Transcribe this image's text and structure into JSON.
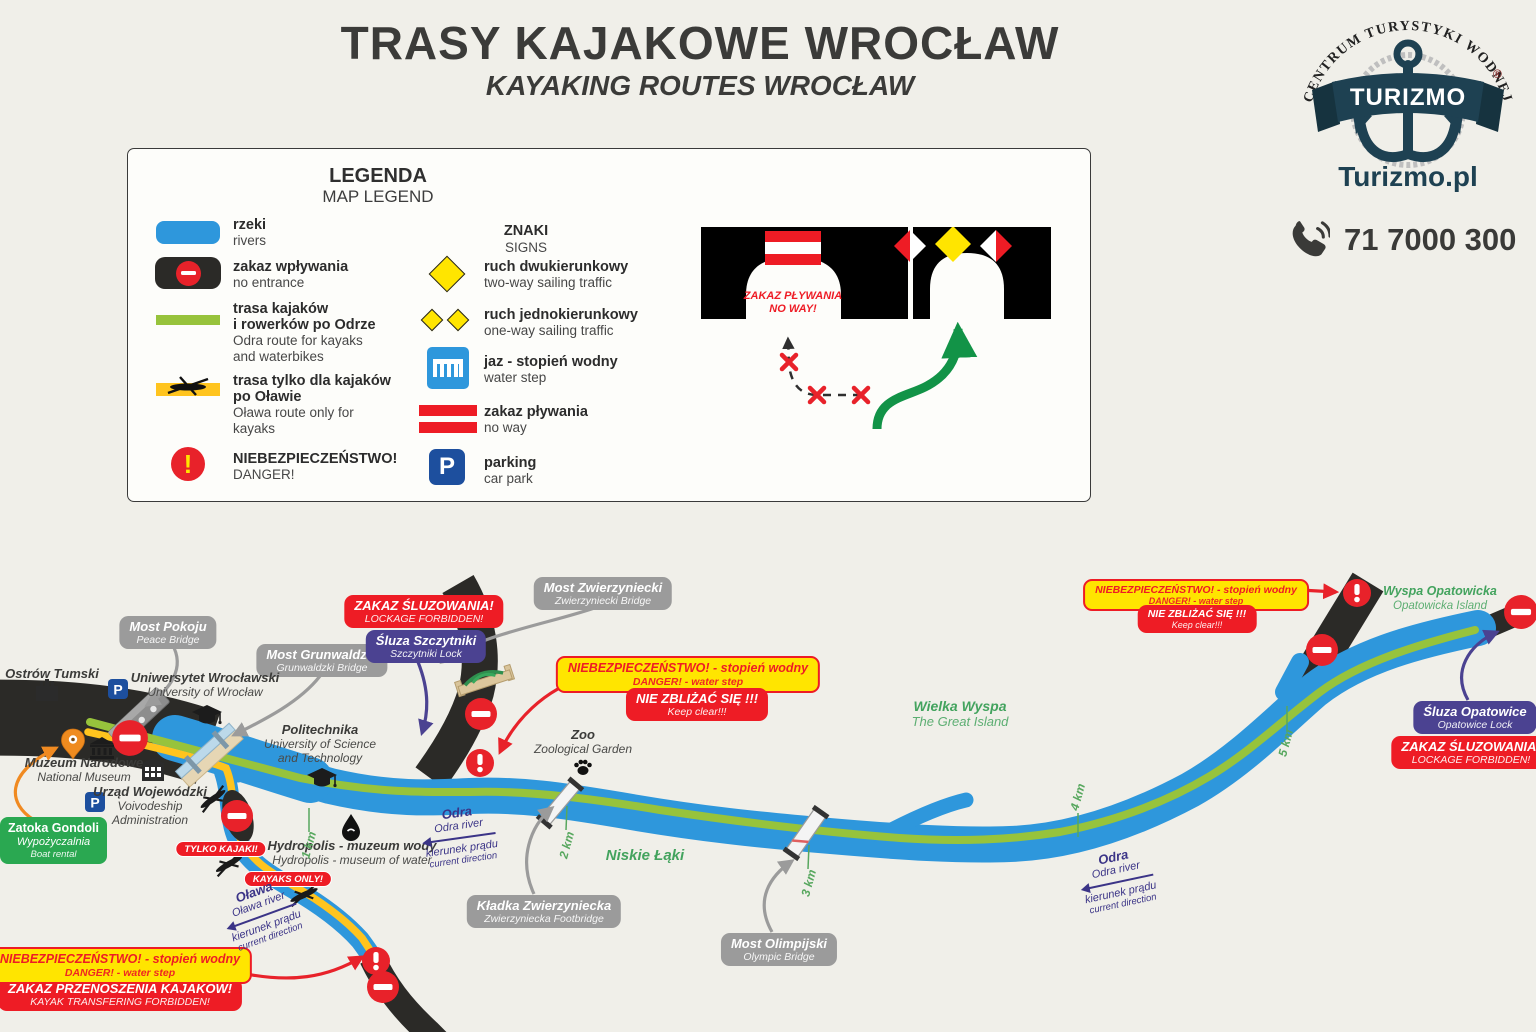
{
  "header": {
    "title": "TRASY KAJAKOWE WROCŁAW",
    "subtitle": "KAYAKING ROUTES WROCŁAW"
  },
  "brand": {
    "arc": "CENTRUM TURYSTYKI WODNEJ",
    "banner": "TURIZMO",
    "reg": "®",
    "site": "Turizmo.pl",
    "phone": "71 7000 300"
  },
  "symbols": {
    "exclamation": "!",
    "parking": "P"
  },
  "legend": {
    "title": "LEGENDA",
    "subtitle": "MAP LEGEND",
    "rivers_t": "rzeki",
    "rivers_s": "rivers",
    "noent_t": "zakaz wpływania",
    "noent_s": "no entrance",
    "odra_t1": "trasa kajaków",
    "odra_t2": "i rowerków po Odrze",
    "odra_s1": "Odra route for kayaks",
    "odra_s2": "and waterbikes",
    "olawa_t1": "trasa tylko dla kajaków",
    "olawa_t2": "po Oławie",
    "olawa_s1": "Oława route only for",
    "olawa_s2": "kayaks",
    "danger_t": "NIEBEZPIECZEŃSTWO!",
    "danger_s": "DANGER!",
    "signs_t": "ZNAKI",
    "signs_s": "SIGNS",
    "twoway_t": "ruch dwukierunkowy",
    "twoway_s": "two-way sailing traffic",
    "oneway_t": "ruch jednokierunkowy",
    "oneway_s": "one-way sailing traffic",
    "weir_t": "jaz - stopień wodny",
    "weir_s": "water step",
    "noway_t": "zakaz pływania",
    "noway_s": "no way",
    "parking_t": "parking",
    "parking_s": "car park",
    "panel_t": "ZAKAZ PŁYWANIA",
    "panel_s": "NO WAY!"
  },
  "map": {
    "pokoju_pl": "Most Pokoju",
    "pokoju_en": "Peace Bridge",
    "grunwaldzki_pl": "Most Grunwaldzki",
    "grunwaldzki_en": "Grunwaldzki Bridge",
    "zwierzyniecki_pl": "Most Zwierzyniecki",
    "zwierzyniecki_en": "Zwierzyniecki Bridge",
    "kladka_pl": "Kładka Zwierzyniecka",
    "kladka_en": "Zwierzyniecka Footbridge",
    "olimpijski_pl": "Most Olimpijski",
    "olimpijski_en": "Olympic Bridge",
    "szczytniki_pl": "Śluza Szczytniki",
    "szczytniki_en": "Szczytniki Lock",
    "opatowice_pl": "Śluza Opatowice",
    "opatowice_en": "Opatowice Lock",
    "lockage_pl": "ZAKAZ ŚLUZOWANIA!",
    "lockage_en": "LOCKAGE FORBIDDEN!",
    "danger_pl": "NIEBEZPIECZEŃSTWO! - stopień wodny",
    "danger_en": "DANGER! - water step",
    "keep_pl": "NIE ZBLIŻAĆ SIĘ !!!",
    "keep_en": "Keep clear!!!",
    "transfer_pl": "ZAKAZ PRZENOSZENIA KAJAKÓW!",
    "transfer_en": "KAYAK TRANSFERING FORBIDDEN!",
    "tylko": "TYLKO KAJAKI!",
    "kayaksonly": "KAYAKS ONLY!",
    "ostrow": "Ostrów Tumski",
    "uni_pl": "Uniwersytet Wrocławski",
    "uni_en": "University of Wrocław",
    "muzeum_pl": "Muzeum Narodowe",
    "muzeum_en": "National Museum",
    "urzad_pl": "Urząd Wojewódzki",
    "urzad_en1": "Voivodeship",
    "urzad_en2": "Administration",
    "poli_pl": "Politechnika",
    "poli_en1": "University of Science",
    "poli_en2": "and Technology",
    "hydro_pl": "Hydropolis - muzeum wody",
    "hydro_en": "Hydropolis - museum of water",
    "zoo_pl": "Zoo",
    "zoo_en": "Zoological Garden",
    "zatoka_1": "Zatoka Gondoli",
    "zatoka_2": "Wypożyczalnia",
    "zatoka_3": "Boat rental",
    "wielka_pl": "Wielka Wyspa",
    "wielka_en": "The Great Island",
    "niskie": "Niskie Łąki",
    "opatowicka_pl": "Wyspa Opatowicka",
    "opatowicka_en": "Opatowicka Island",
    "odra_pl": "Odra",
    "odra_en": "Odra river",
    "olawa_pl": "Oława",
    "olawa_en": "Oława river",
    "current_pl": "kierunek prądu",
    "current_en": "current direction",
    "km1": "1 km",
    "km2": "2 km",
    "km3": "3 km",
    "km4": "4 km",
    "km5": "5 km"
  },
  "colors": {
    "river": "#2e97dc",
    "odra_route": "#97c33c",
    "olawa_route": "#ffc41e",
    "forbidden_black": "#2b2a27",
    "danger_red": "#e8222a",
    "warning_yellow": "#ffe500",
    "lock_purple": "#4b4291",
    "label_gray": "#9b9b9b",
    "area_green": "#43a35e",
    "direction_purple": "#3b3487",
    "rental_green": "#2aa851"
  }
}
